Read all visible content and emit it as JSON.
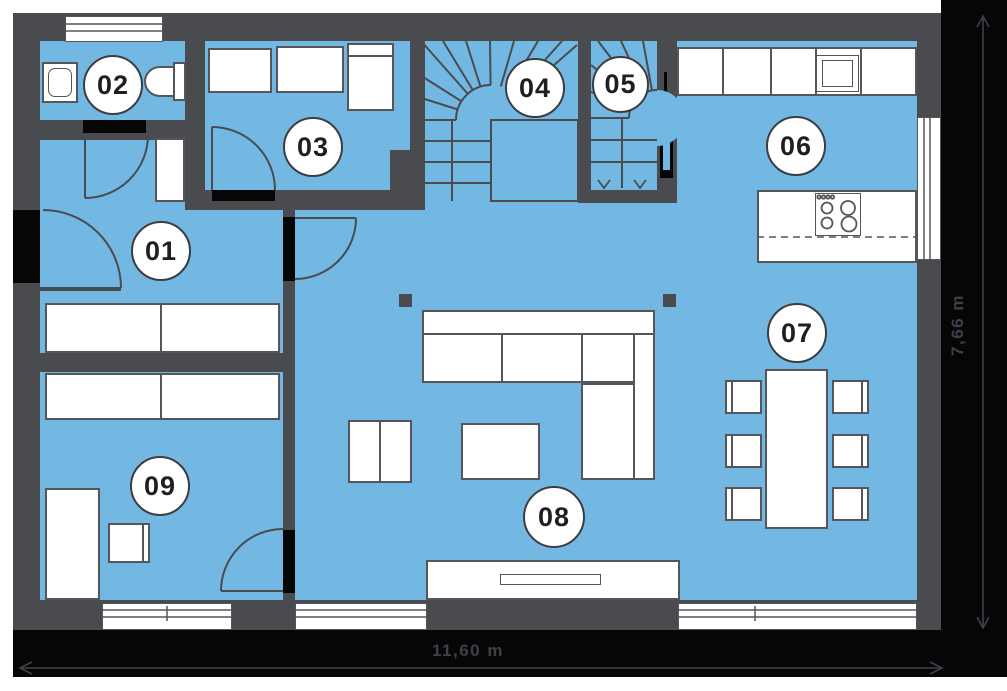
{
  "plan": {
    "type": "floor-plan",
    "rooms": [
      {
        "id": "room-01",
        "label": "01"
      },
      {
        "id": "room-02",
        "label": "02"
      },
      {
        "id": "room-03",
        "label": "03"
      },
      {
        "id": "room-04",
        "label": "04"
      },
      {
        "id": "room-05",
        "label": "05"
      },
      {
        "id": "room-06",
        "label": "06"
      },
      {
        "id": "room-07",
        "label": "07"
      },
      {
        "id": "room-08",
        "label": "08"
      },
      {
        "id": "room-09",
        "label": "09"
      }
    ],
    "dimensions": {
      "width_label": "11,60 m",
      "height_label": "7,66 m"
    },
    "colors": {
      "floor": "#73b8e3",
      "wall": "#4a4b4e",
      "band": "#060606",
      "furniture_outline": "#54565a",
      "dimension_text": "#3e414c"
    }
  }
}
